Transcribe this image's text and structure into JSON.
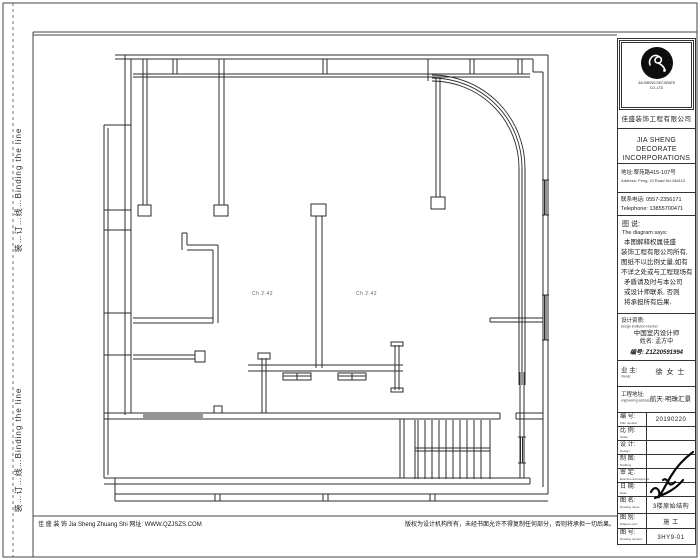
{
  "binding": {
    "label": "装…订…线…Binding the line"
  },
  "plan": {
    "room_label_1": "Ch 2.42",
    "room_label_2": "Ch 2.42"
  },
  "title_block": {
    "logo": {
      "icon": "swirl-logo",
      "tagline_line1": "JIA SHENG DECORATE",
      "tagline_line2": "CO.,LTD",
      "company_cn": "佳盛装饰工程有限公司"
    },
    "company_en_line1": "JIA SHENG DECORATE",
    "company_en_line2": "INCORPORATIONS",
    "address_cn": "地址:翠苑路415-107号",
    "address_en": "Address: Feng, Gl Road No.15#110",
    "phone_cn": "联系电话: 0557-2356171",
    "phone_en": "Telephone: 13855700471",
    "notes": {
      "title_cn": "图 说:",
      "title_en": "The diagram says:",
      "lines": [
        "本图解释权属佳盛",
        "装饰工程有限公司所有,",
        "图纸不以比例丈量,如有",
        "不详之处或与工程现场有",
        "矛盾请及时与本公司",
        "或设计师联系, 否则",
        "将承担所有后果."
      ]
    },
    "credential": {
      "label_cn": "设计资质:",
      "label_en": "Design institution Number:",
      "org": "中国室内设计师",
      "name": "姓名: 孟方中",
      "no": "编号: Z1Z20591994"
    },
    "owner": {
      "label_cn": "业 主:",
      "label_en": "Owner:",
      "value": "徐 女 士"
    },
    "site": {
      "label_cn": "工程地址:",
      "label_en": "engineering address:",
      "value": "航天·明珠汇景"
    },
    "rows": [
      {
        "label": "编 号:",
        "label_en": "Plan number:",
        "value": "20190220"
      },
      {
        "label": "比 例:",
        "label_en": "Scale:",
        "value": ""
      },
      {
        "label": "设 计:",
        "label_en": "Design:",
        "value": ""
      },
      {
        "label": "制 图:",
        "label_en": "Drafting:",
        "value": ""
      },
      {
        "label": "审 定:",
        "label_en": "Examine and approve:",
        "value": ""
      },
      {
        "label": "日 期:",
        "label_en": "Date:",
        "value": ""
      },
      {
        "label": "图 名:",
        "label_en": "Drawing name:",
        "value": "3楼原始结构"
      },
      {
        "label": "图 别:",
        "label_en": "Diagram sort:",
        "value": "施 工"
      },
      {
        "label": "图 号:",
        "label_en": "Drawing number:",
        "value": "3HY9-01"
      }
    ]
  },
  "footer": {
    "left": "佳 盛 装 饰 Jia Sheng Zhuang Shi    网址: WWW.QZJSZS.COM",
    "right": "版权为设计机构所有，未经书面允许不得复制任何部分，否则将承担一切后果。"
  }
}
